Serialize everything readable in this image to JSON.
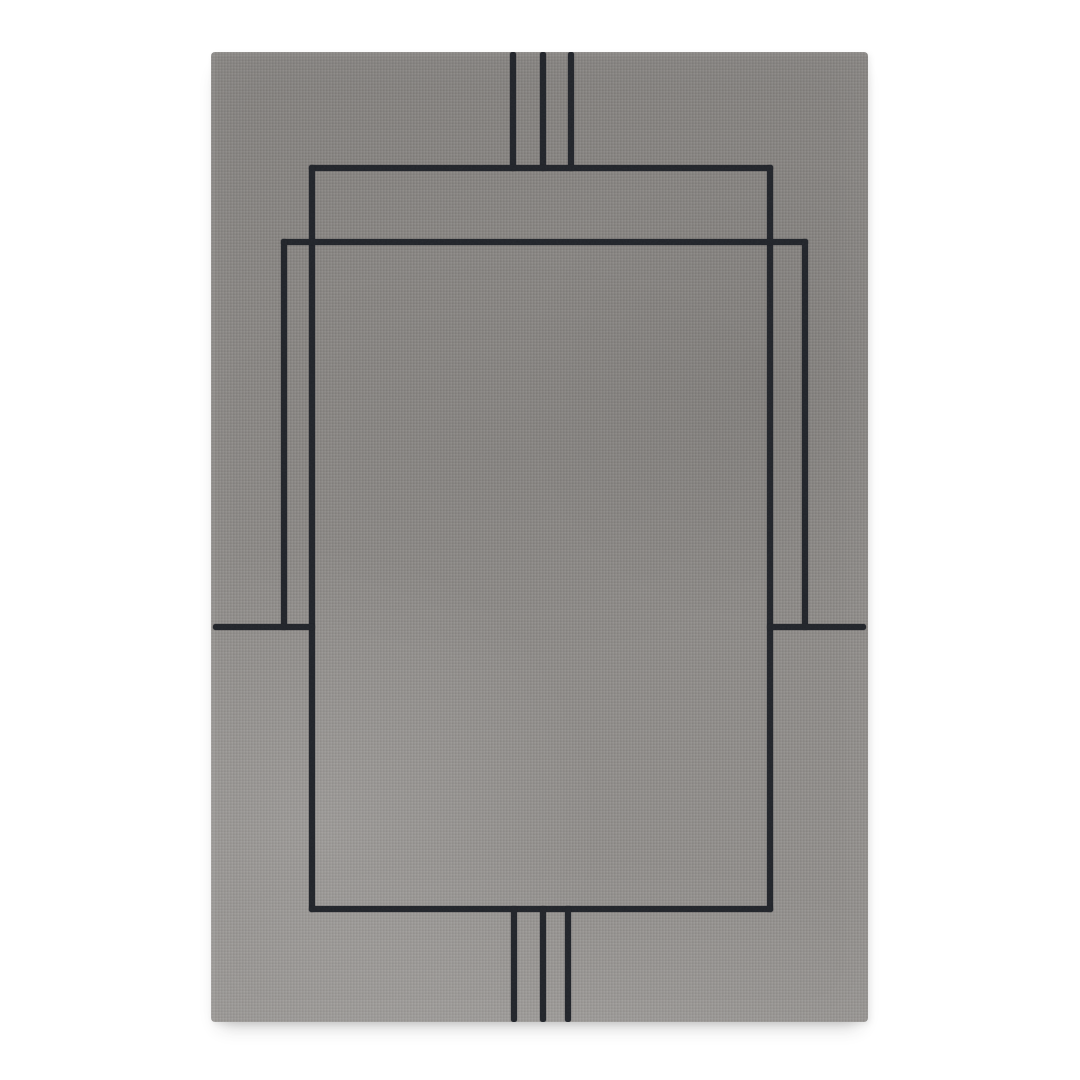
{
  "scene": {
    "description": "Product photograph of a rectangular gray area rug with a minimalist dark charcoal line pattern (nested offset rectangles and triple stripe accents), centered on a plain white background",
    "background_color": "#ffffff"
  },
  "rug": {
    "x": 211,
    "y": 52,
    "width": 657,
    "height": 970,
    "base_color": "#8b8885",
    "highlight_color": "#a3a09b",
    "shade_color": "#7c7976",
    "line_color": "#21242a",
    "line_thickness": 6,
    "lines": [
      {
        "name": "top-stripe-left",
        "x": 299,
        "y": 0,
        "w": 6,
        "h": 119
      },
      {
        "name": "top-stripe-middle",
        "x": 329,
        "y": 0,
        "w": 6,
        "h": 119
      },
      {
        "name": "top-stripe-right",
        "x": 357,
        "y": 0,
        "w": 6,
        "h": 119
      },
      {
        "name": "rect-a-top",
        "x": 98,
        "y": 113,
        "w": 464,
        "h": 6
      },
      {
        "name": "rect-a-left",
        "x": 98,
        "y": 113,
        "w": 6,
        "h": 747
      },
      {
        "name": "rect-a-right",
        "x": 556,
        "y": 113,
        "w": 6,
        "h": 747
      },
      {
        "name": "rect-a-bottom",
        "x": 98,
        "y": 854,
        "w": 464,
        "h": 6
      },
      {
        "name": "rect-b-top",
        "x": 70,
        "y": 187,
        "w": 527,
        "h": 6
      },
      {
        "name": "rect-b-left",
        "x": 70,
        "y": 187,
        "w": 6,
        "h": 391
      },
      {
        "name": "rect-b-right",
        "x": 591,
        "y": 187,
        "w": 6,
        "h": 391
      },
      {
        "name": "stub-left",
        "x": 2,
        "y": 572,
        "w": 102,
        "h": 6
      },
      {
        "name": "stub-right",
        "x": 556,
        "y": 572,
        "w": 99,
        "h": 6
      },
      {
        "name": "bottom-stripe-left",
        "x": 300,
        "y": 854,
        "w": 6,
        "h": 116
      },
      {
        "name": "bottom-stripe-middle",
        "x": 329,
        "y": 854,
        "w": 6,
        "h": 116
      },
      {
        "name": "bottom-stripe-right",
        "x": 354,
        "y": 854,
        "w": 6,
        "h": 116
      }
    ]
  }
}
